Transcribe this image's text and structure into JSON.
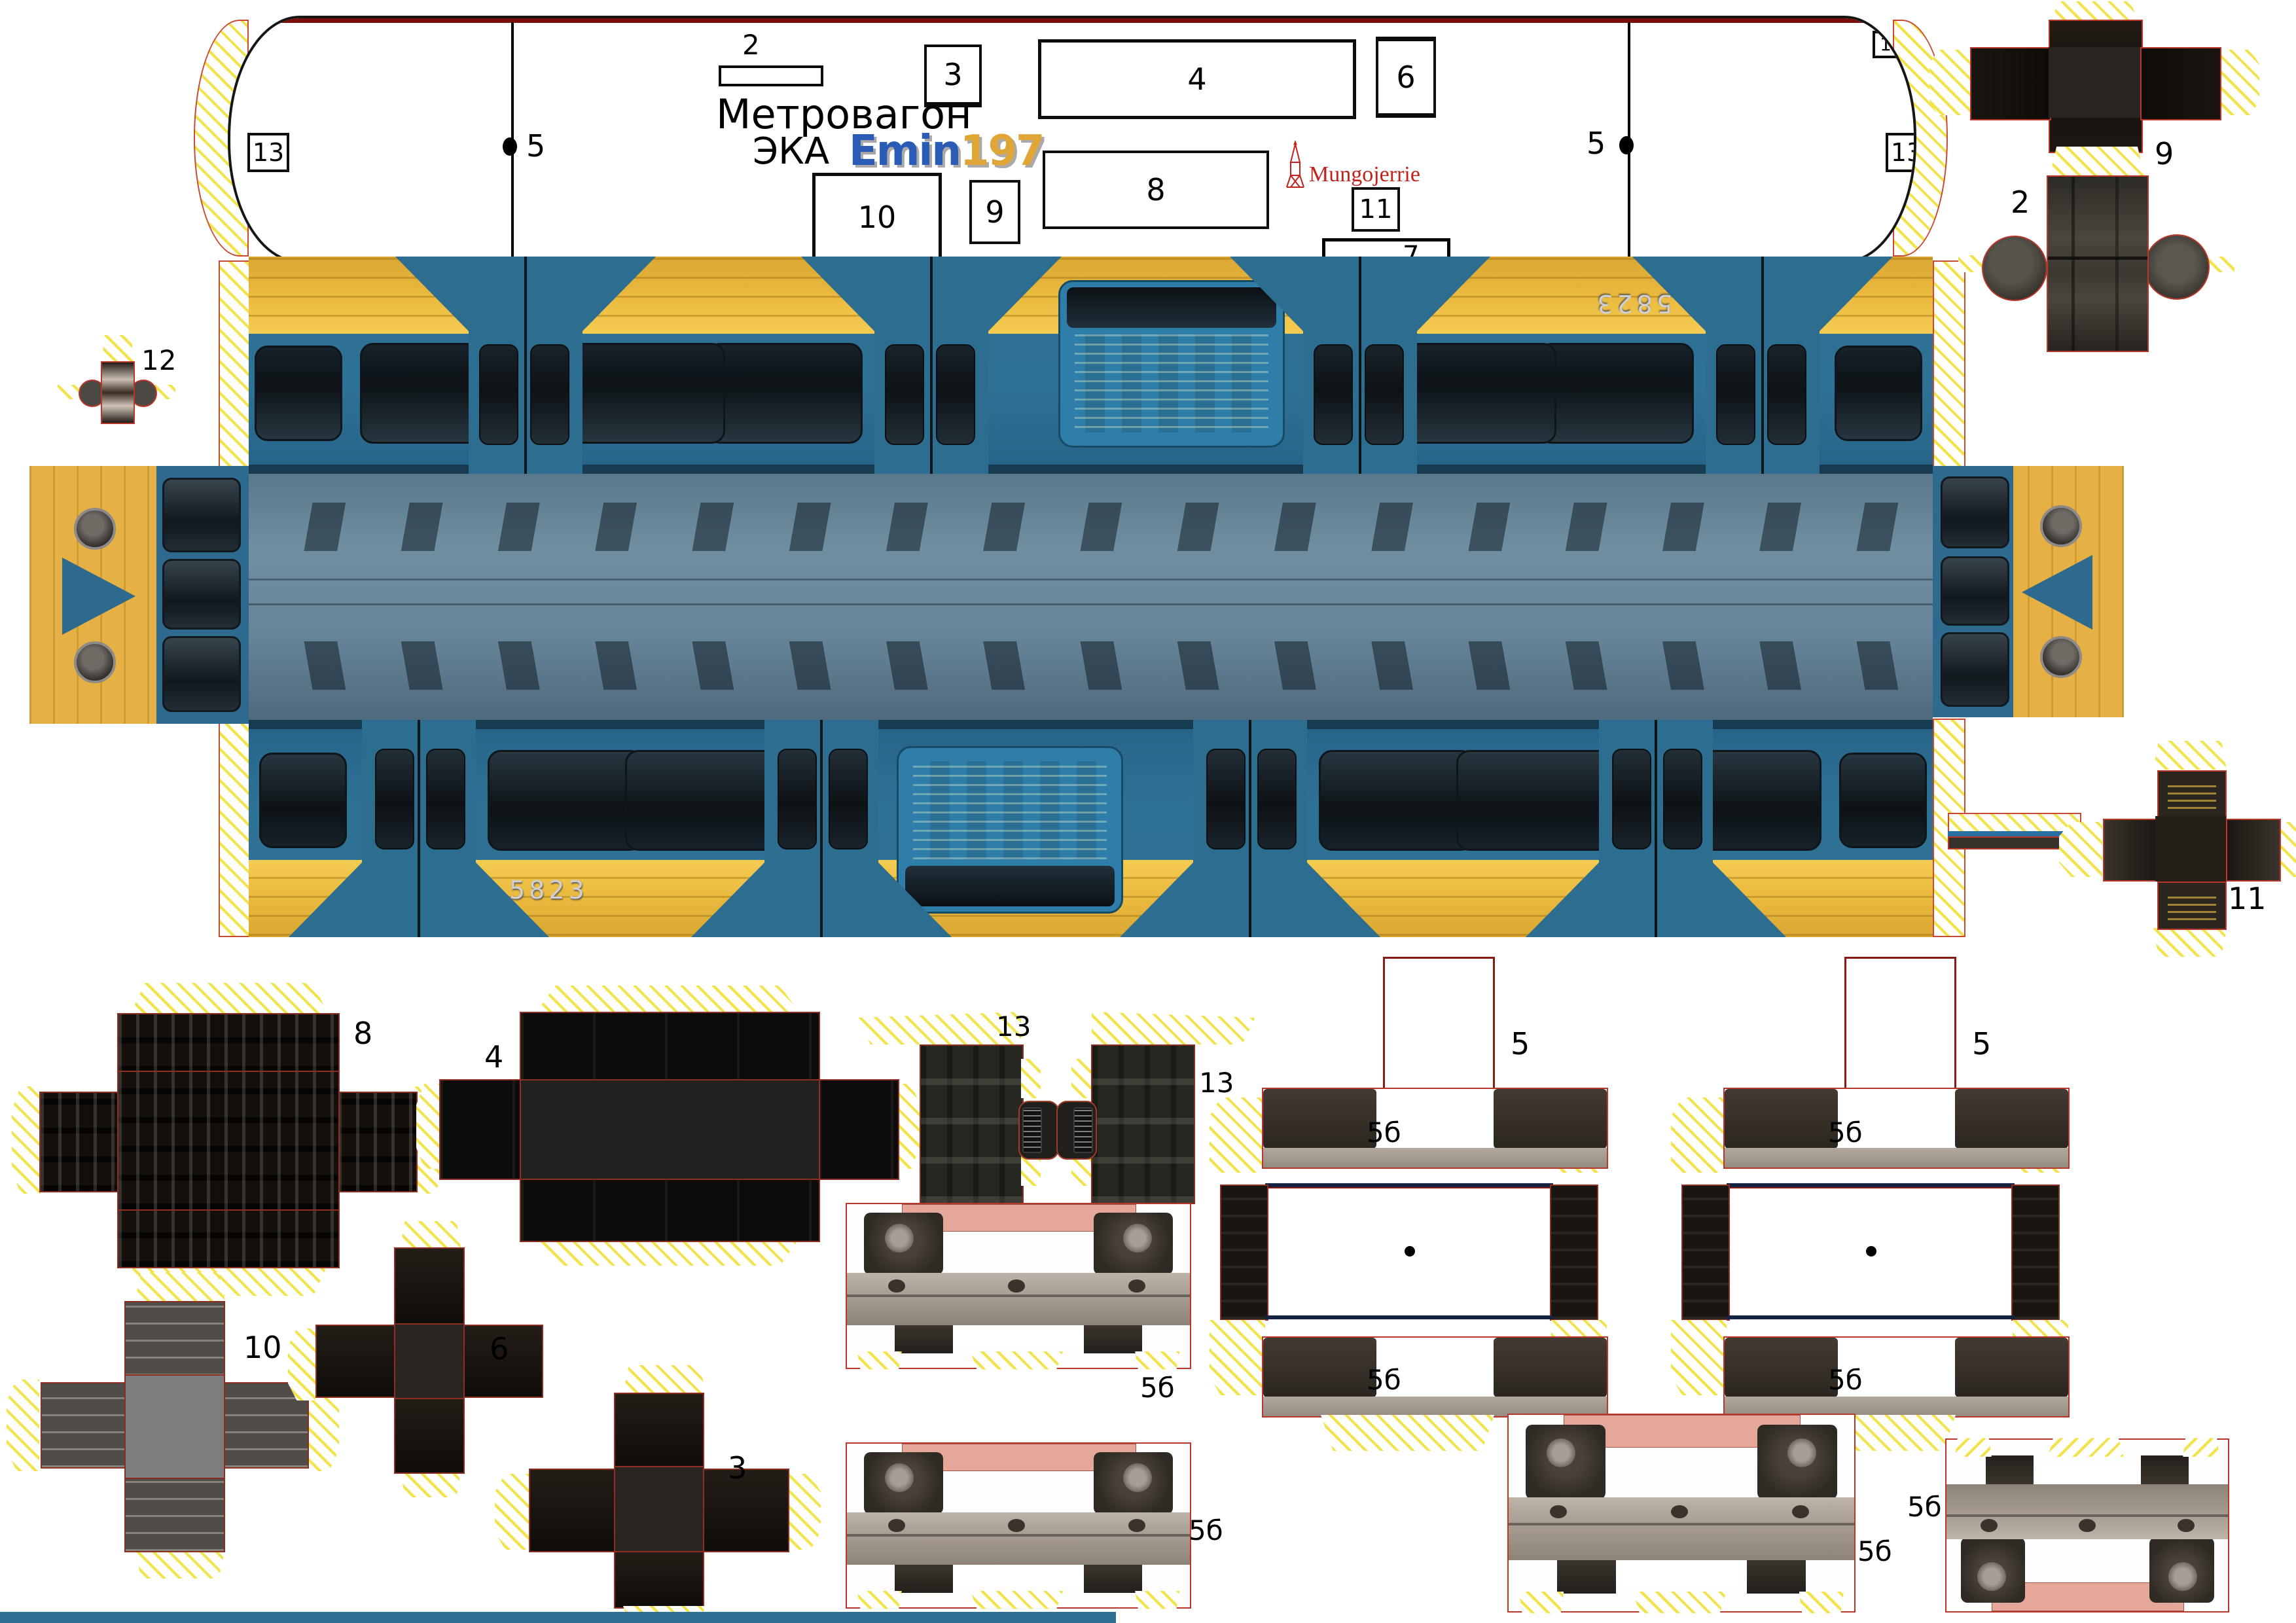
{
  "header": {
    "title_line1": "Метровагон",
    "title_line2": "ЭКА",
    "logo_text": "Emin",
    "logo_number": "197",
    "credit": "Mungojerrie"
  },
  "car": {
    "number": "5823"
  },
  "labels": {
    "p2": "2",
    "p3": "3",
    "p4": "4",
    "p5": "5",
    "p6": "6",
    "p7": "7",
    "p8": "8",
    "p9": "9",
    "p10": "10",
    "p11": "11",
    "p12": "12",
    "p13": "13",
    "bogie": "5б"
  },
  "colors": {
    "body_blue": "#2d6f93",
    "stripe_yellow": "#eebe45",
    "hatch_yellow": "#f3e34a",
    "cut_red": "#c84a32",
    "logo_blue": "#2a5cb5",
    "logo_gold": "#dfa637",
    "credit_red": "#c2211c"
  }
}
